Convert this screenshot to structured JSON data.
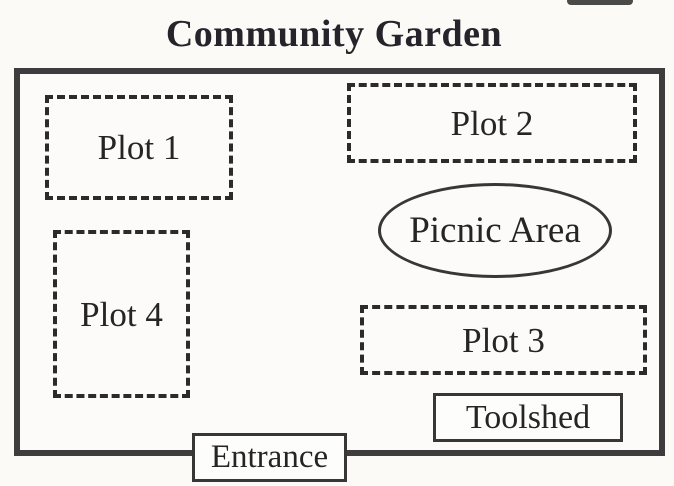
{
  "title": "Community Garden",
  "colors": {
    "paper": "#fbfaf7",
    "ink": "#262424",
    "boundary_border": "#403c3d",
    "dashed_border": "#2c2a2a"
  },
  "areas": [
    {
      "id": "plot-1",
      "label": "Plot 1",
      "shape": "dashed-rect"
    },
    {
      "id": "plot-2",
      "label": "Plot 2",
      "shape": "dashed-rect"
    },
    {
      "id": "picnic",
      "label": "Picnic Area",
      "shape": "ellipse"
    },
    {
      "id": "plot-4",
      "label": "Plot 4",
      "shape": "dashed-rect"
    },
    {
      "id": "plot-3",
      "label": "Plot 3",
      "shape": "dashed-rect"
    },
    {
      "id": "toolshed",
      "label": "Toolshed",
      "shape": "solid-rect"
    },
    {
      "id": "entrance",
      "label": "Entrance",
      "shape": "solid-rect"
    }
  ]
}
